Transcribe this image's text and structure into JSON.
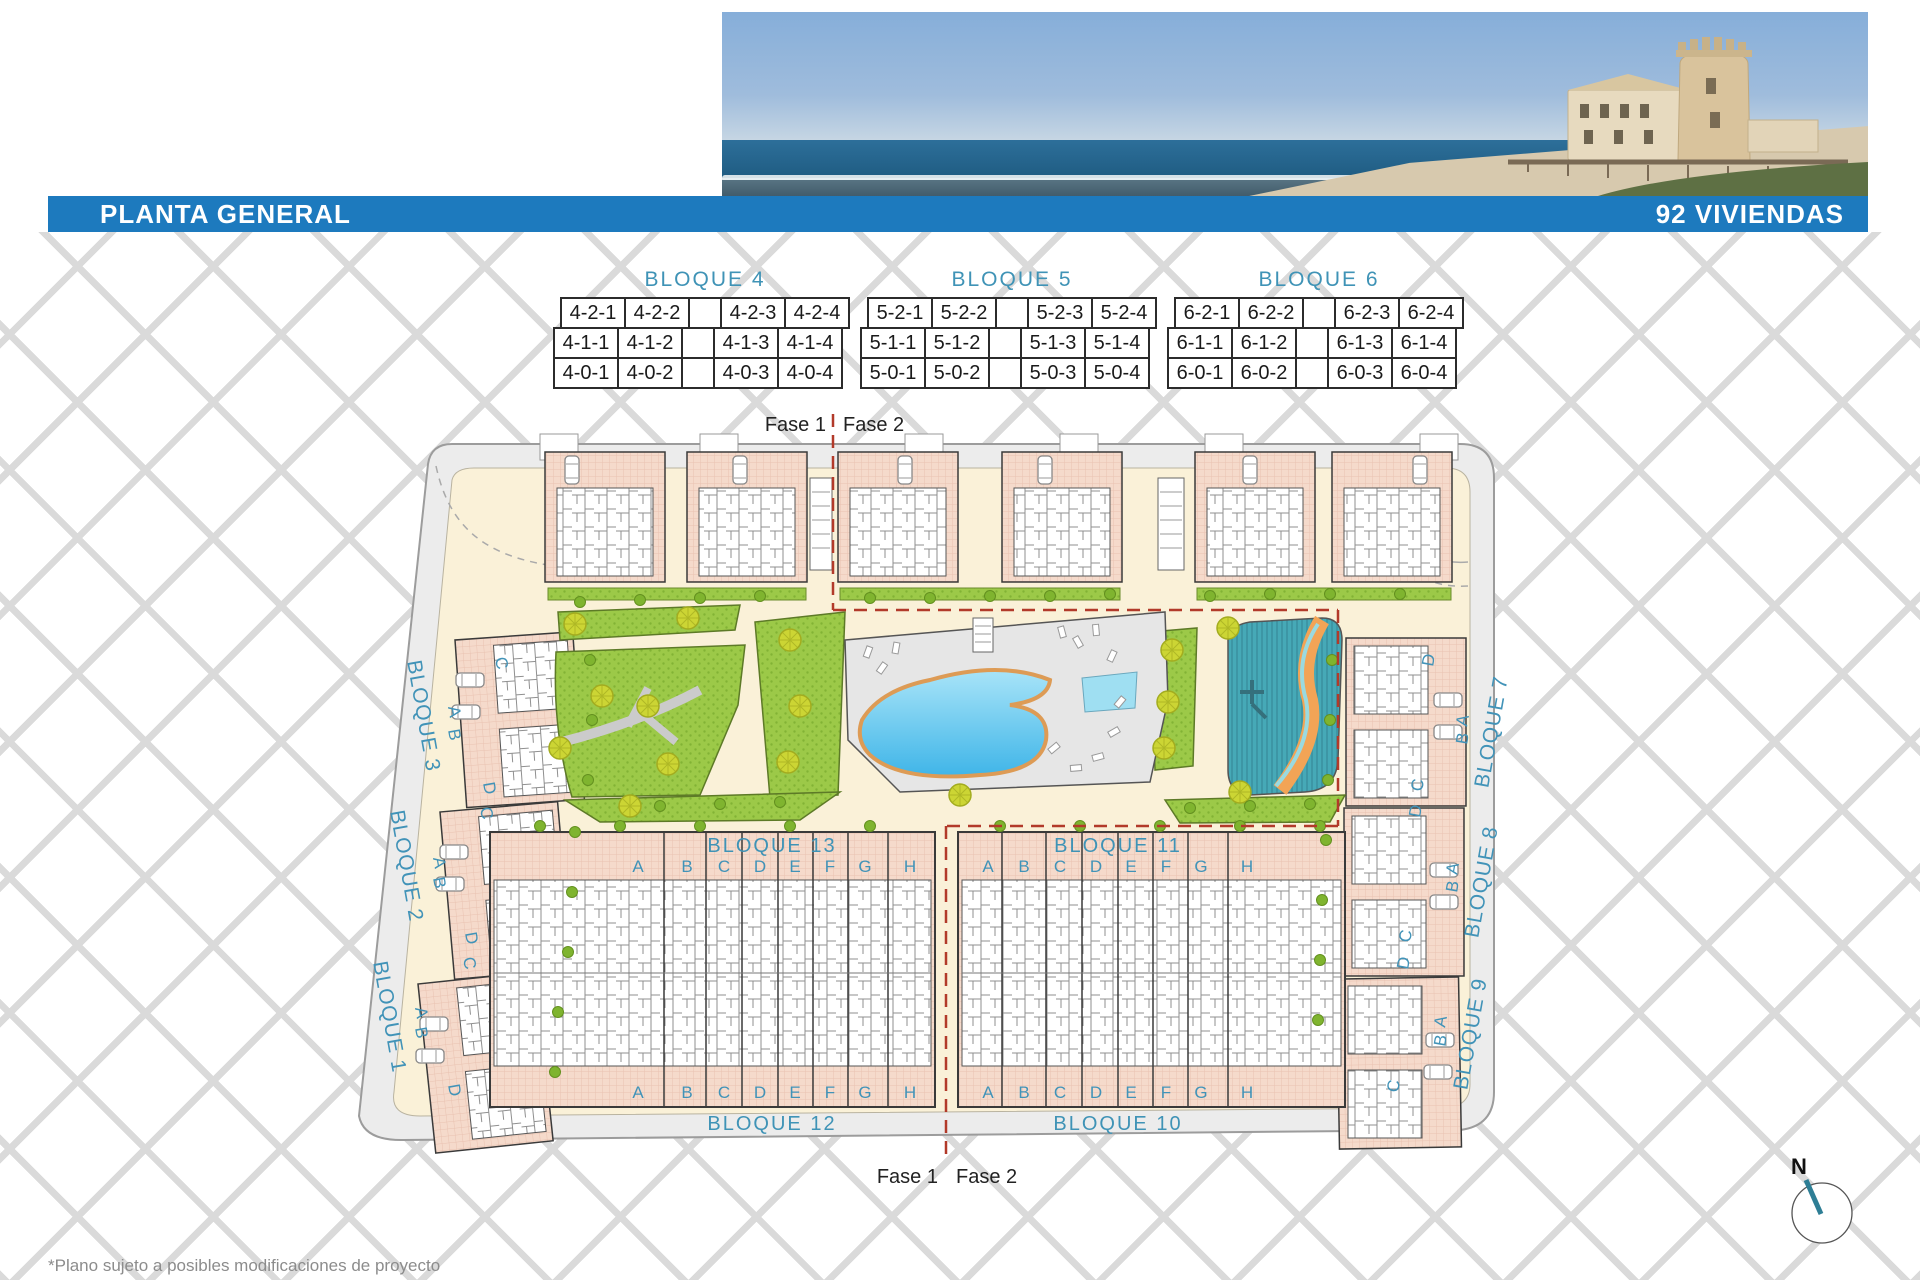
{
  "header": {
    "title": "PLANTA GENERAL",
    "units": "92 VIVIENDAS"
  },
  "colors": {
    "accent_blue": "#1d7abe",
    "label_teal": "#4193b8",
    "phase_line_red": "#b23a2a",
    "building_salmon": "#f5dacb",
    "path_cream": "#faf1d8",
    "park_green": "#9cc948",
    "pool_blue": "#3fb5e8",
    "splash_teal": "#46a9b7",
    "river_orange": "#f2a456"
  },
  "legend_tables": [
    {
      "title": "BLOQUE 4",
      "rows": [
        {
          "cells": [
            "4-2-1",
            "4-2-2",
            "",
            "4-2-3",
            "4-2-4"
          ]
        },
        {
          "cells": [
            "4-1-1",
            "4-1-2",
            "",
            "4-1-3",
            "4-1-4"
          ]
        },
        {
          "cells": [
            "4-0-1",
            "4-0-2",
            "",
            "4-0-3",
            "4-0-4"
          ]
        }
      ]
    },
    {
      "title": "BLOQUE 5",
      "rows": [
        {
          "cells": [
            "5-2-1",
            "5-2-2",
            "",
            "5-2-3",
            "5-2-4"
          ]
        },
        {
          "cells": [
            "5-1-1",
            "5-1-2",
            "",
            "5-1-3",
            "5-1-4"
          ]
        },
        {
          "cells": [
            "5-0-1",
            "5-0-2",
            "",
            "5-0-3",
            "5-0-4"
          ]
        }
      ]
    },
    {
      "title": "BLOQUE 6",
      "rows": [
        {
          "cells": [
            "6-2-1",
            "6-2-2",
            "",
            "6-2-3",
            "6-2-4"
          ]
        },
        {
          "cells": [
            "6-1-1",
            "6-1-2",
            "",
            "6-1-3",
            "6-1-4"
          ]
        },
        {
          "cells": [
            "6-0-1",
            "6-0-2",
            "",
            "6-0-3",
            "6-0-4"
          ]
        }
      ]
    }
  ],
  "plan": {
    "fase_top": {
      "left": "Fase 1",
      "right": "Fase 2"
    },
    "fase_bottom": {
      "left": "Fase 1",
      "right": "Fase 2"
    },
    "left_blocks": [
      "BLOQUE 3",
      "BLOQUE 2",
      "BLOQUE 1"
    ],
    "right_blocks": [
      "BLOQUE 7",
      "BLOQUE 8",
      "BLOQUE 9"
    ],
    "center_blocks": {
      "top_left": "BLOQUE 13",
      "top_right": "BLOQUE 11",
      "bottom_left": "BLOQUE 12",
      "bottom_right": "BLOQUE 10"
    },
    "unit_letters": [
      "A",
      "B",
      "C",
      "D",
      "E",
      "F",
      "G",
      "H"
    ],
    "side_letters_left": [
      "C",
      "A",
      "B",
      "D"
    ],
    "side_letters_right": [
      "D",
      "A",
      "B",
      "C"
    ],
    "compass_label": "N"
  },
  "footnote": "*Plano sujeto a posibles modificaciones de proyecto"
}
